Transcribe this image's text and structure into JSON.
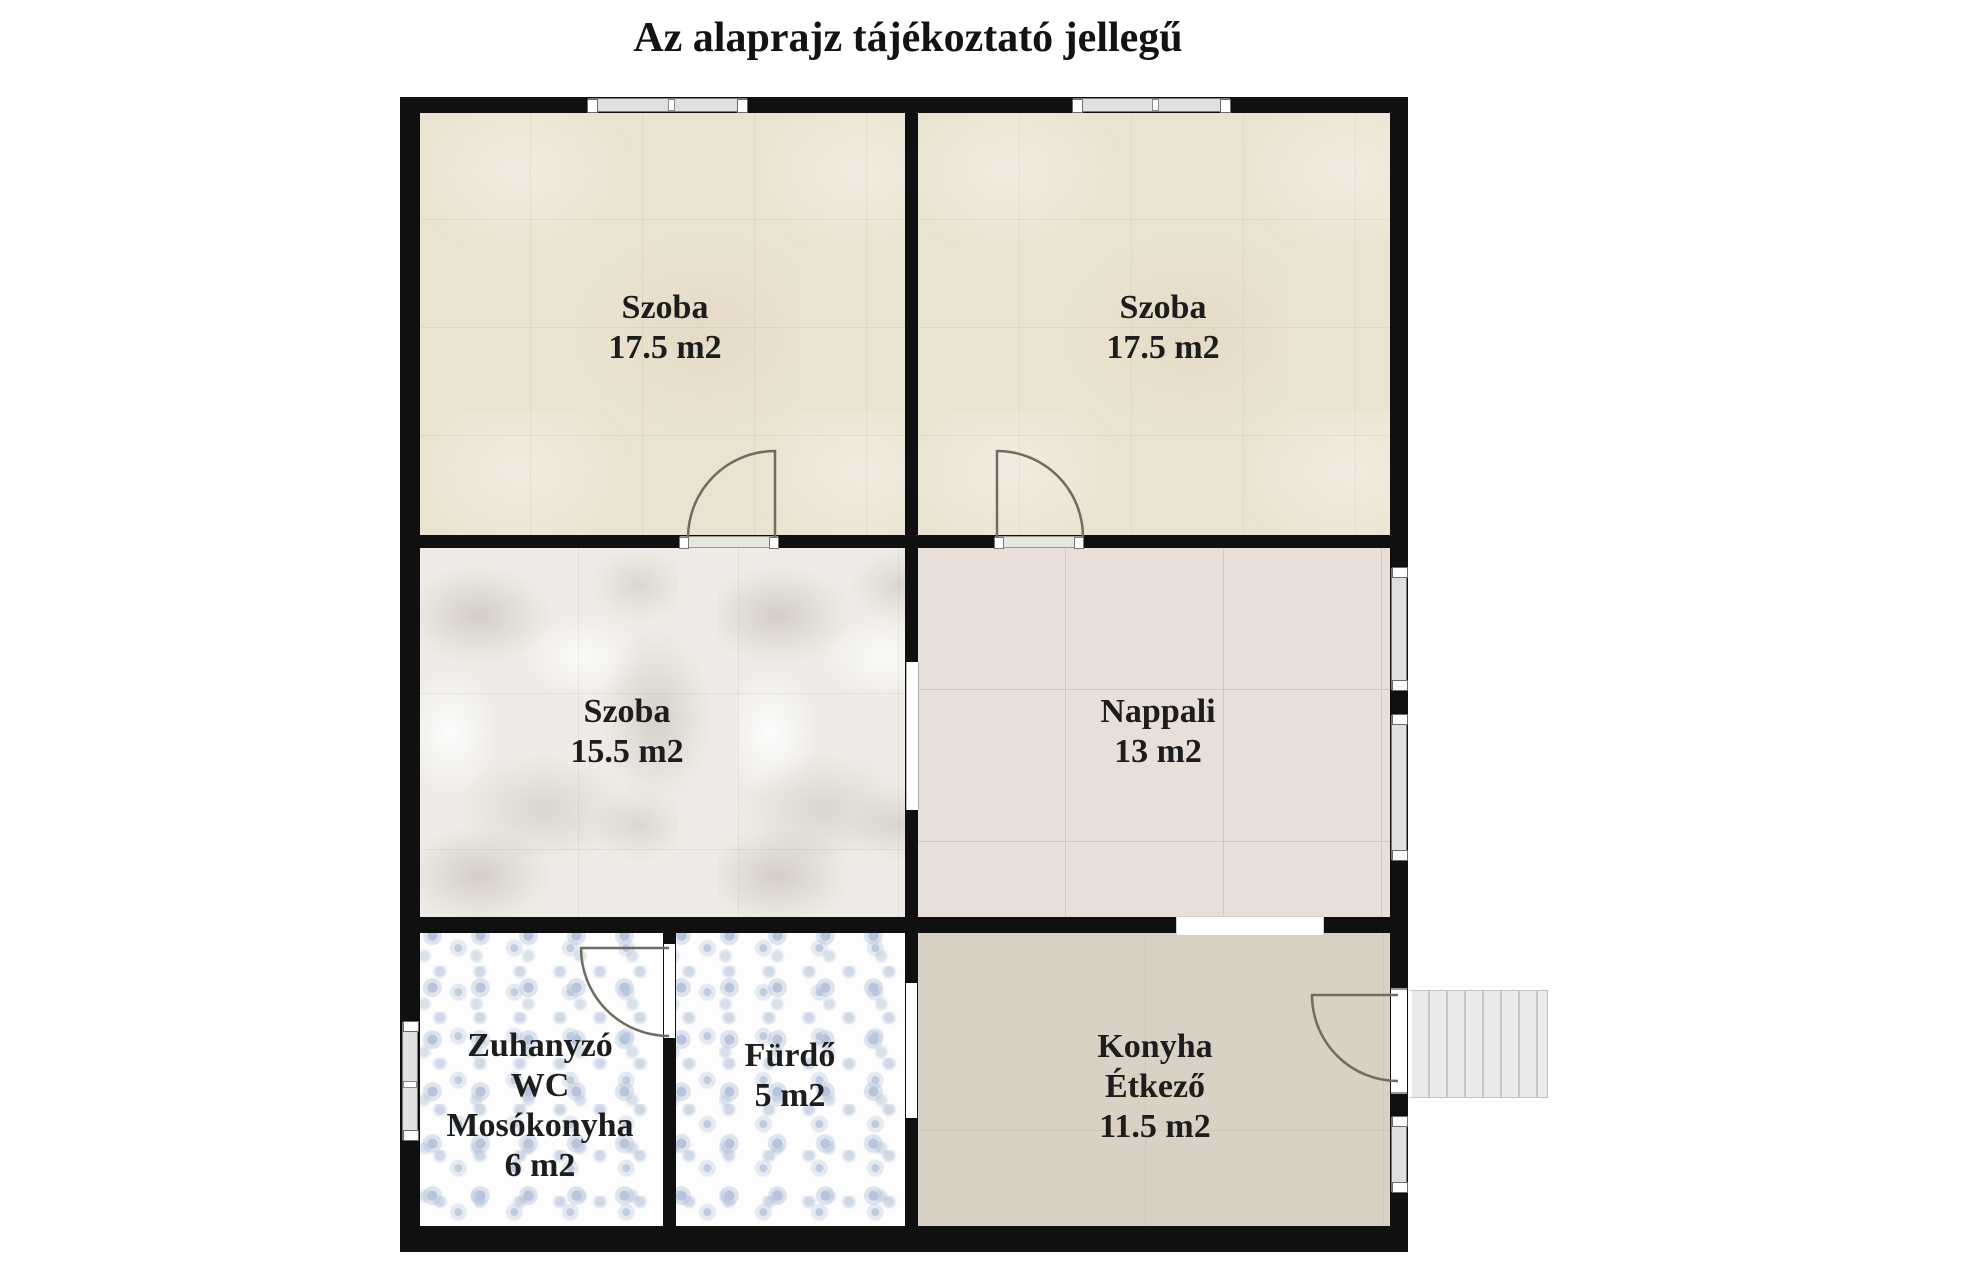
{
  "title": "Az alaprajz tájékoztató jellegű",
  "rooms": [
    {
      "name": "Szoba",
      "area": "17.5 m2",
      "lines": [
        "Szoba",
        "17.5 m2"
      ]
    },
    {
      "name": "Szoba",
      "area": "17.5 m2",
      "lines": [
        "Szoba",
        "17.5 m2"
      ]
    },
    {
      "name": "Szoba",
      "area": "15.5 m2",
      "lines": [
        "Szoba",
        "15.5 m2"
      ]
    },
    {
      "name": "Nappali",
      "area": "13 m2",
      "lines": [
        "Nappali",
        "13 m2"
      ]
    },
    {
      "name": "Zuhanyzó WC Mosókonyha",
      "area": "6 m2",
      "lines": [
        "Zuhanyzó",
        "WC",
        "Mosókonyha",
        "6 m2"
      ]
    },
    {
      "name": "Fürdő",
      "area": "5 m2",
      "lines": [
        "Fürdő",
        "5 m2"
      ]
    },
    {
      "name": "Konyha Étkező",
      "area": "11.5 m2",
      "lines": [
        "Konyha",
        "Étkező",
        "11.5 m2"
      ]
    }
  ],
  "colors": {
    "wall": "#101010",
    "cream_floor": "#ebe3d1",
    "marble_floor": "#efece7",
    "nappali_floor": "#e7dfd8",
    "floral_tile": "#b6c5db",
    "konyha_floor": "#d9d1c3",
    "window_fill": "#e0e0e0",
    "stairs_fill": "#eaeaea"
  }
}
